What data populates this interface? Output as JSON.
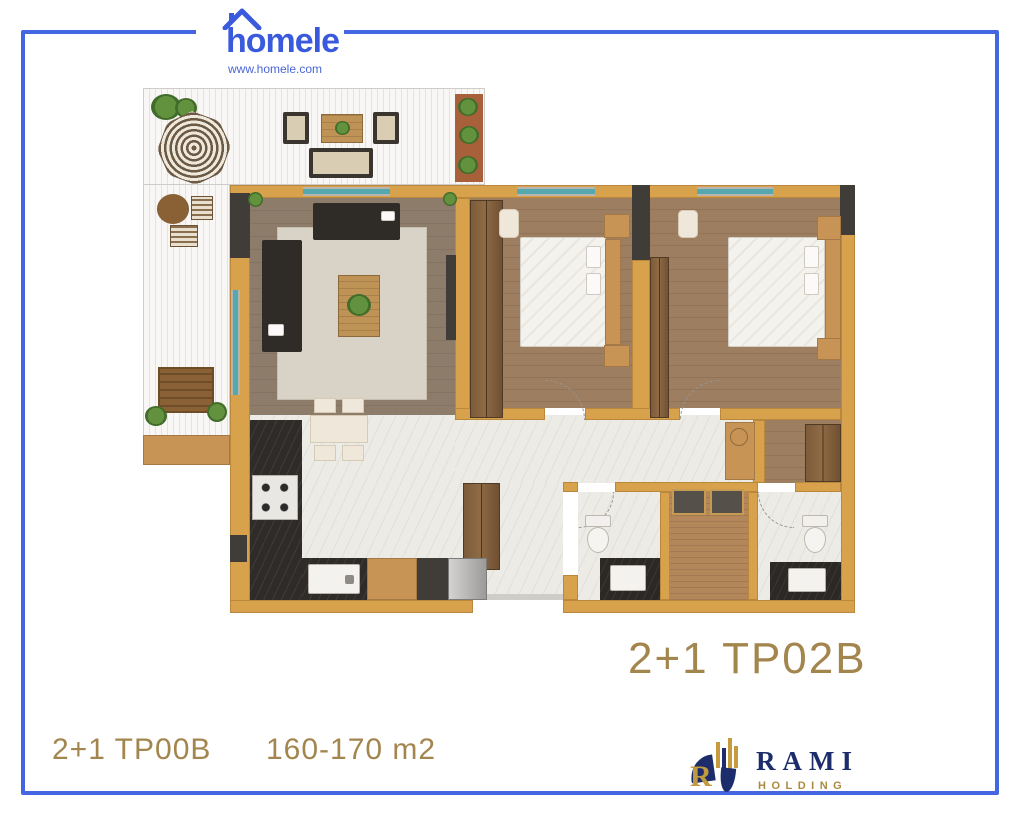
{
  "header": {
    "brand": "homele",
    "website": "www.homele.com"
  },
  "unit": {
    "plan_code": "2+1 TP02B"
  },
  "footer": {
    "unit_type": "2+1 TP00B",
    "area_range": "160-170 m2"
  },
  "developer": {
    "name": "RAMI",
    "division": "HOLDING",
    "monogram": "R"
  },
  "colors": {
    "frame_blue": "#4566e2",
    "brand_blue": "#3a5add",
    "accent_gold": "#a3854e",
    "wall_gold": "#d7a24b",
    "navy": "#1d2d6b",
    "logo_gold": "#ab8b42",
    "window_teal": "#55a9ae"
  }
}
